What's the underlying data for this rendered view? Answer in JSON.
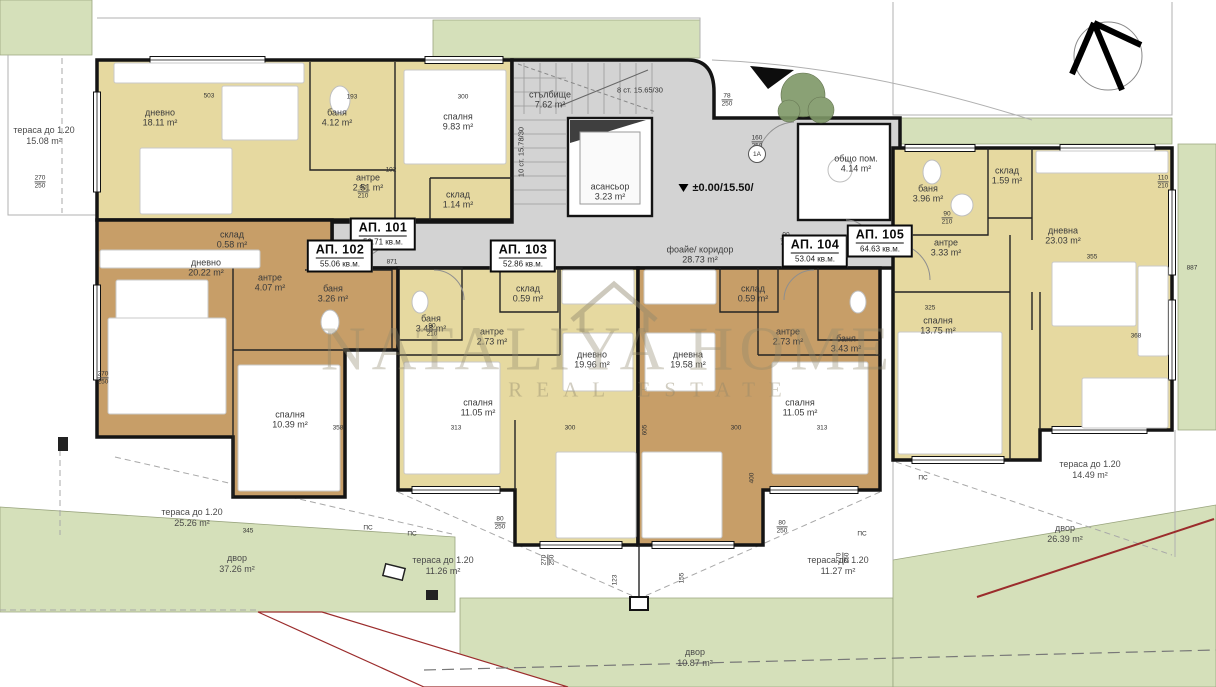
{
  "site": {
    "watermark": {
      "line1": "NATALIYA HOME",
      "line2": "REAL ESTATE"
    },
    "level_mark": "±0.00/15.50/",
    "node_label": "1А"
  },
  "colors": {
    "apartment_light": "#e6d9a0",
    "apartment_dark": "#c79e68",
    "common_area": "#d3d3d3",
    "lawn": "#d5e0ba",
    "boundary_red": "#9b2c2c"
  },
  "apartments": [
    {
      "id": "АП. 101",
      "area": "52.71 кв.м.",
      "x": 383,
      "y": 234
    },
    {
      "id": "АП. 102",
      "area": "55.06 кв.м.",
      "x": 340,
      "y": 256
    },
    {
      "id": "АП. 103",
      "area": "52.86 кв.м.",
      "x": 523,
      "y": 256
    },
    {
      "id": "АП. 104",
      "area": "53.04 кв.м.",
      "x": 815,
      "y": 251
    },
    {
      "id": "АП. 105",
      "area": "64.63 кв.м.",
      "x": 880,
      "y": 241
    }
  ],
  "rooms": [
    {
      "label": "дневно",
      "area": "18.11 m²",
      "x": 160,
      "y": 118
    },
    {
      "label": "баня",
      "area": "4.12 m²",
      "x": 337,
      "y": 118
    },
    {
      "label": "спалня",
      "area": "9.83 m²",
      "x": 458,
      "y": 122
    },
    {
      "label": "антре",
      "area": "2.51 m²",
      "x": 368,
      "y": 183
    },
    {
      "label": "склад",
      "area": "1.14 m²",
      "x": 458,
      "y": 200
    },
    {
      "label": "склад",
      "area": "0.58 m²",
      "x": 232,
      "y": 240
    },
    {
      "label": "дневно",
      "area": "20.22 m²",
      "x": 206,
      "y": 268
    },
    {
      "label": "антре",
      "area": "4.07 m²",
      "x": 270,
      "y": 283
    },
    {
      "label": "баня",
      "area": "3.26 m²",
      "x": 333,
      "y": 294
    },
    {
      "label": "спалня",
      "area": "10.39 m²",
      "x": 290,
      "y": 420
    },
    {
      "label": "баня",
      "area": "3.48 m²",
      "x": 431,
      "y": 324
    },
    {
      "label": "склад",
      "area": "0.59 m²",
      "x": 528,
      "y": 294
    },
    {
      "label": "антре",
      "area": "2.73 m²",
      "x": 492,
      "y": 337
    },
    {
      "label": "дневно",
      "area": "19.96 m²",
      "x": 592,
      "y": 360
    },
    {
      "label": "спалня",
      "area": "11.05 m²",
      "x": 478,
      "y": 408
    },
    {
      "label": "склад",
      "area": "0.59 m²",
      "x": 753,
      "y": 294
    },
    {
      "label": "антре",
      "area": "2.73 m²",
      "x": 788,
      "y": 337
    },
    {
      "label": "баня",
      "area": "3.43 m²",
      "x": 846,
      "y": 344
    },
    {
      "label": "дневна",
      "area": "19.58 m²",
      "x": 688,
      "y": 360
    },
    {
      "label": "спалня",
      "area": "11.05 m²",
      "x": 800,
      "y": 408
    },
    {
      "label": "баня",
      "area": "3.96 m²",
      "x": 928,
      "y": 194
    },
    {
      "label": "склад",
      "area": "1.59 m²",
      "x": 1007,
      "y": 176
    },
    {
      "label": "антре",
      "area": "3.33 m²",
      "x": 946,
      "y": 248
    },
    {
      "label": "дневна",
      "area": "23.03 m²",
      "x": 1063,
      "y": 236
    },
    {
      "label": "спалня",
      "area": "13.75 m²",
      "x": 938,
      "y": 326
    },
    {
      "label": "стълбище",
      "area": "7.62 m²",
      "x": 550,
      "y": 100
    },
    {
      "label": "асансьор",
      "area": "3.23 m²",
      "x": 610,
      "y": 192
    },
    {
      "label": "фоайе/ коридор",
      "area": "28.73 m²",
      "x": 700,
      "y": 255
    },
    {
      "label": "общо пом.",
      "area": "4.14 m²",
      "x": 856,
      "y": 164
    }
  ],
  "site_labels": [
    {
      "label": "тераса до 1.20",
      "area": "15.08 m²",
      "x": 44,
      "y": 136
    },
    {
      "label": "тераса до 1.20",
      "area": "25.26 m²",
      "x": 192,
      "y": 518
    },
    {
      "label": "тераса до 1.20",
      "area": "11.26 m²",
      "x": 443,
      "y": 566
    },
    {
      "label": "тераса до 1.20",
      "area": "11.27 m²",
      "x": 838,
      "y": 566
    },
    {
      "label": "тераса до 1.20",
      "area": "14.49 m²",
      "x": 1090,
      "y": 470
    },
    {
      "label": "двор",
      "area": "37.26 m²",
      "x": 237,
      "y": 564
    },
    {
      "label": "двор",
      "area": "10.87 m²",
      "x": 695,
      "y": 658
    },
    {
      "label": "двор",
      "area": "26.39 m²",
      "x": 1065,
      "y": 534
    }
  ],
  "stairs_notes": [
    {
      "text": "8 ст. 15.65/30",
      "x": 640,
      "y": 90,
      "rot": 0
    },
    {
      "text": "10 ст. 15.78/30",
      "x": 521,
      "y": 152,
      "rot": -90
    }
  ],
  "dimensions": [
    {
      "a": "270",
      "b": "250",
      "x": 40,
      "y": 182
    },
    {
      "a": "270",
      "b": "250",
      "x": 103,
      "y": 378
    },
    {
      "a": "503",
      "x": 209,
      "y": 96
    },
    {
      "a": "193",
      "x": 352,
      "y": 97
    },
    {
      "a": "300",
      "x": 463,
      "y": 97
    },
    {
      "a": "192",
      "x": 391,
      "y": 170
    },
    {
      "a": "90",
      "b": "210",
      "x": 363,
      "y": 192
    },
    {
      "a": "90",
      "b": "210",
      "x": 947,
      "y": 218
    },
    {
      "a": "78",
      "b": "250",
      "x": 727,
      "y": 100
    },
    {
      "a": "160",
      "b": "250",
      "x": 757,
      "y": 142
    },
    {
      "a": "871",
      "x": 392,
      "y": 262
    },
    {
      "a": "887",
      "x": 1192,
      "y": 268
    },
    {
      "a": "355",
      "x": 1092,
      "y": 257
    },
    {
      "a": "325",
      "x": 930,
      "y": 308
    },
    {
      "a": "368",
      "x": 1136,
      "y": 336
    },
    {
      "a": "313",
      "x": 456,
      "y": 428
    },
    {
      "a": "300",
      "x": 570,
      "y": 428
    },
    {
      "a": "358",
      "x": 338,
      "y": 428
    },
    {
      "a": "345",
      "x": 248,
      "y": 531
    },
    {
      "a": "313",
      "x": 822,
      "y": 428
    },
    {
      "a": "300",
      "x": 736,
      "y": 428
    },
    {
      "a": "90",
      "b": "210",
      "x": 432,
      "y": 330
    },
    {
      "a": "90",
      "b": "210",
      "x": 786,
      "y": 239
    },
    {
      "a": "110",
      "b": "210",
      "x": 1163,
      "y": 182
    },
    {
      "a": "605",
      "x": 645,
      "y": 430,
      "rot": -90
    },
    {
      "a": "400",
      "x": 752,
      "y": 478,
      "rot": -90
    },
    {
      "a": "123",
      "x": 615,
      "y": 580,
      "rot": -90
    },
    {
      "a": "155",
      "x": 682,
      "y": 578,
      "rot": -90
    },
    {
      "a": "80",
      "b": "250",
      "x": 500,
      "y": 523
    },
    {
      "a": "80",
      "b": "250",
      "x": 782,
      "y": 527
    },
    {
      "a": "270",
      "b": "250",
      "x": 548,
      "y": 560,
      "rot": -90
    },
    {
      "a": "270",
      "b": "250",
      "x": 843,
      "y": 558,
      "rot": -90
    },
    {
      "a": "ПС",
      "x": 368,
      "y": 528
    },
    {
      "a": "ПС",
      "x": 412,
      "y": 534
    },
    {
      "a": "ПС",
      "x": 923,
      "y": 478
    },
    {
      "a": "ПС",
      "x": 862,
      "y": 534
    }
  ]
}
